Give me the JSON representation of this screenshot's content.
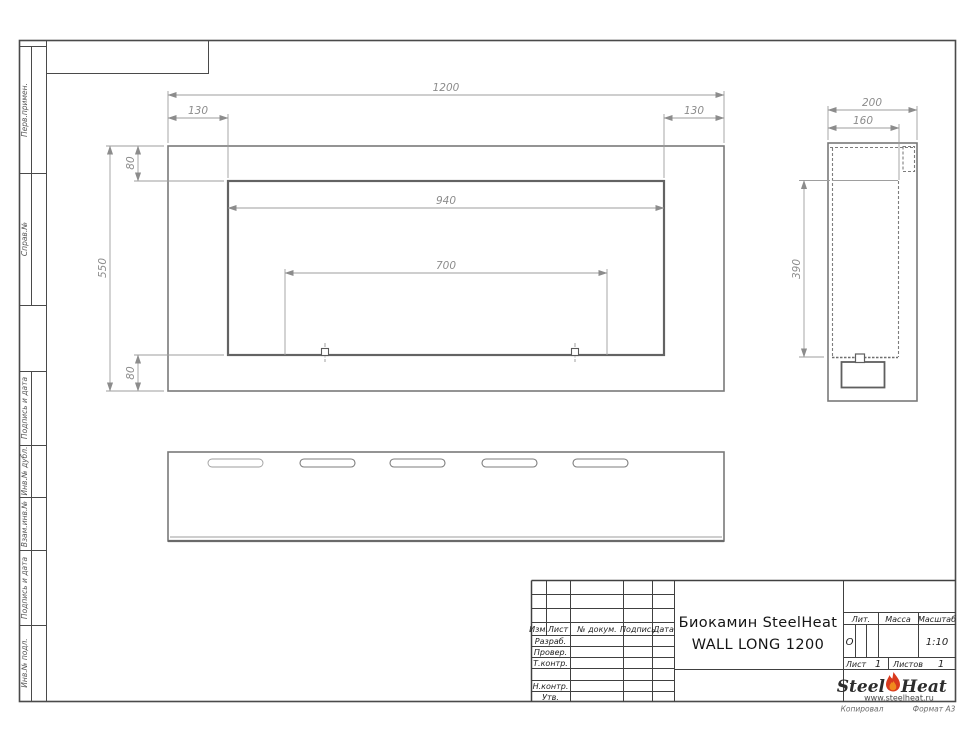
{
  "frame": {
    "stamp_labels_top": [
      "Перв.примен.",
      "Справ.№"
    ],
    "stamp_labels_bottom": [
      "Подпись и дата",
      "Инв.№ дубл.",
      "Взам.инв.№",
      "Подпись и дата",
      "Инв.№ подл."
    ]
  },
  "drawing": {
    "front_view": {
      "overall_width": "1200",
      "left_offset": "130",
      "right_offset": "130",
      "opening_width": "940",
      "mount_spacing": "700",
      "overall_height": "550",
      "top_offset": "80",
      "bottom_offset": "80"
    },
    "side_view": {
      "overall_depth": "200",
      "inner_depth": "160",
      "opening_height": "390"
    }
  },
  "title_block": {
    "header_cols": {
      "izm": "Изм.",
      "list": "Лист",
      "doc": "№ докум.",
      "sign": "Подпись",
      "date": "Дата"
    },
    "rows": {
      "developed": "Разраб.",
      "checked": "Провер.",
      "tcontrol": "Т.контр.",
      "ncontrol": "Н.контр.",
      "approved": "Утв."
    },
    "doc_title_line1": "Биокамин SteelHeat",
    "doc_title_line2": "WALL LONG 1200",
    "lit_label": "Лит.",
    "lit_value": "О",
    "mass_label": "Масса",
    "scale_label": "Масштаб",
    "scale_value": "1:10",
    "sheet_label": "Лист",
    "sheet_number": "1",
    "sheets_label": "Листов",
    "sheets_total": "1",
    "logo": {
      "word1": "Steel",
      "word2": "Heat",
      "site": "www.steelheat.ru"
    },
    "footer": {
      "copied": "Копировал",
      "format": "Формат А3"
    }
  },
  "colors": {
    "outline": "#7a7a7a",
    "dimension": "#9e9e9e",
    "frame": "#404040",
    "flame_red": "#d93a1e",
    "flame_orange": "#f08a1e"
  }
}
